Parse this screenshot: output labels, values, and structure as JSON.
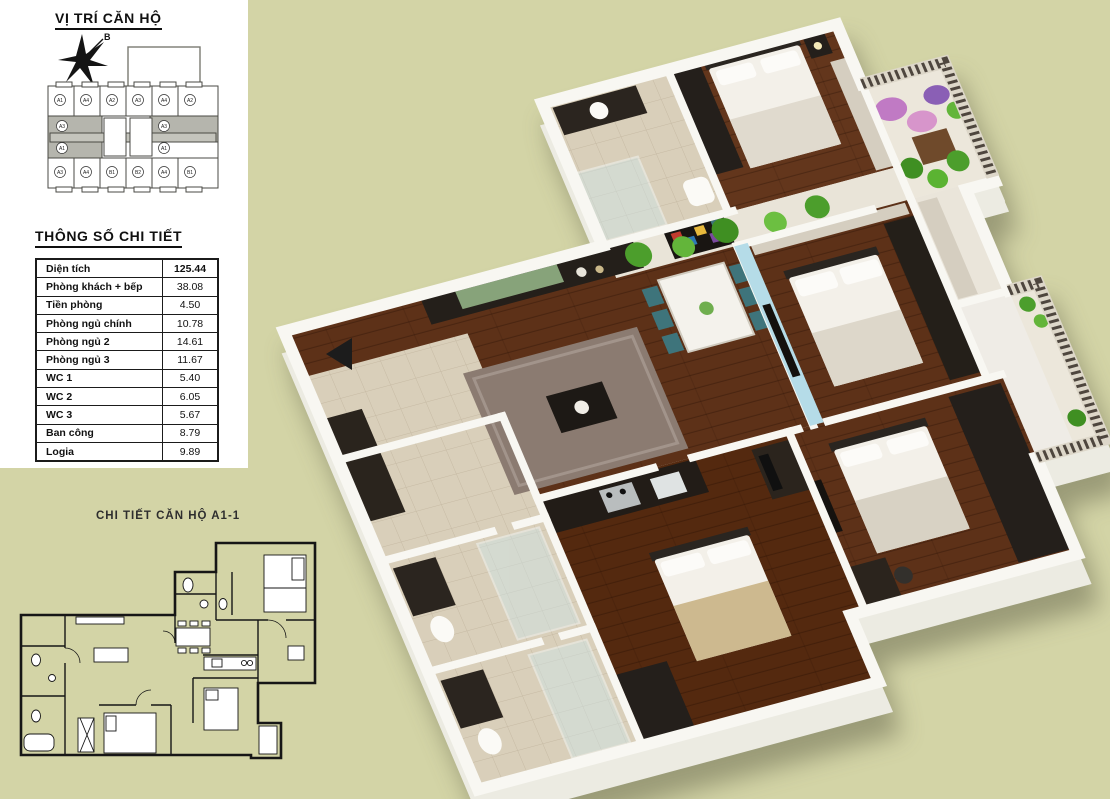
{
  "location": {
    "title": "VỊ TRÍ CĂN HỘ",
    "compass_label": "B",
    "units": {
      "top": [
        "A1",
        "A4",
        "A2",
        "A3",
        "A4",
        "A2"
      ],
      "mid_left": [
        "A3",
        "A1"
      ],
      "mid_right": [
        "A3",
        "A1"
      ],
      "bottom": [
        "A3",
        "A4",
        "B1",
        "B2",
        "A4",
        "B1"
      ]
    },
    "highlighted_unit": "A1"
  },
  "specs": {
    "title": "THÔNG SỐ CHI TIẾT",
    "rows": [
      {
        "label": "Diện tích",
        "value": "125.44"
      },
      {
        "label": "Phòng khách + bếp",
        "value": "38.08"
      },
      {
        "label": "Tiền phòng",
        "value": "4.50"
      },
      {
        "label": "Phòng ngủ chính",
        "value": "10.78"
      },
      {
        "label": "Phòng ngủ 2",
        "value": "14.61"
      },
      {
        "label": "Phòng ngủ 3",
        "value": "11.67"
      },
      {
        "label": "WC 1",
        "value": "5.40"
      },
      {
        "label": "WC 2",
        "value": "6.05"
      },
      {
        "label": "WC 3",
        "value": "5.67"
      },
      {
        "label": "Ban công",
        "value": "8.79"
      },
      {
        "label": "Logia",
        "value": "9.89"
      }
    ]
  },
  "detail": {
    "title": "CHI TIẾT CĂN HỘ A1-1"
  },
  "colors": {
    "background": "#d3d4a6",
    "panel": "#ffffff",
    "line": "#1b1b1b",
    "wall_white": "#f8f7f2",
    "wood_floor": "#5d3118",
    "tile_beige": "#d9cfba",
    "accent_blue": "#b5dce8",
    "plant_green": "#4c9e2c",
    "furniture_dark": "#241f1b",
    "chair_teal": "#3e747b",
    "rug_gray": "#8b7b71"
  }
}
